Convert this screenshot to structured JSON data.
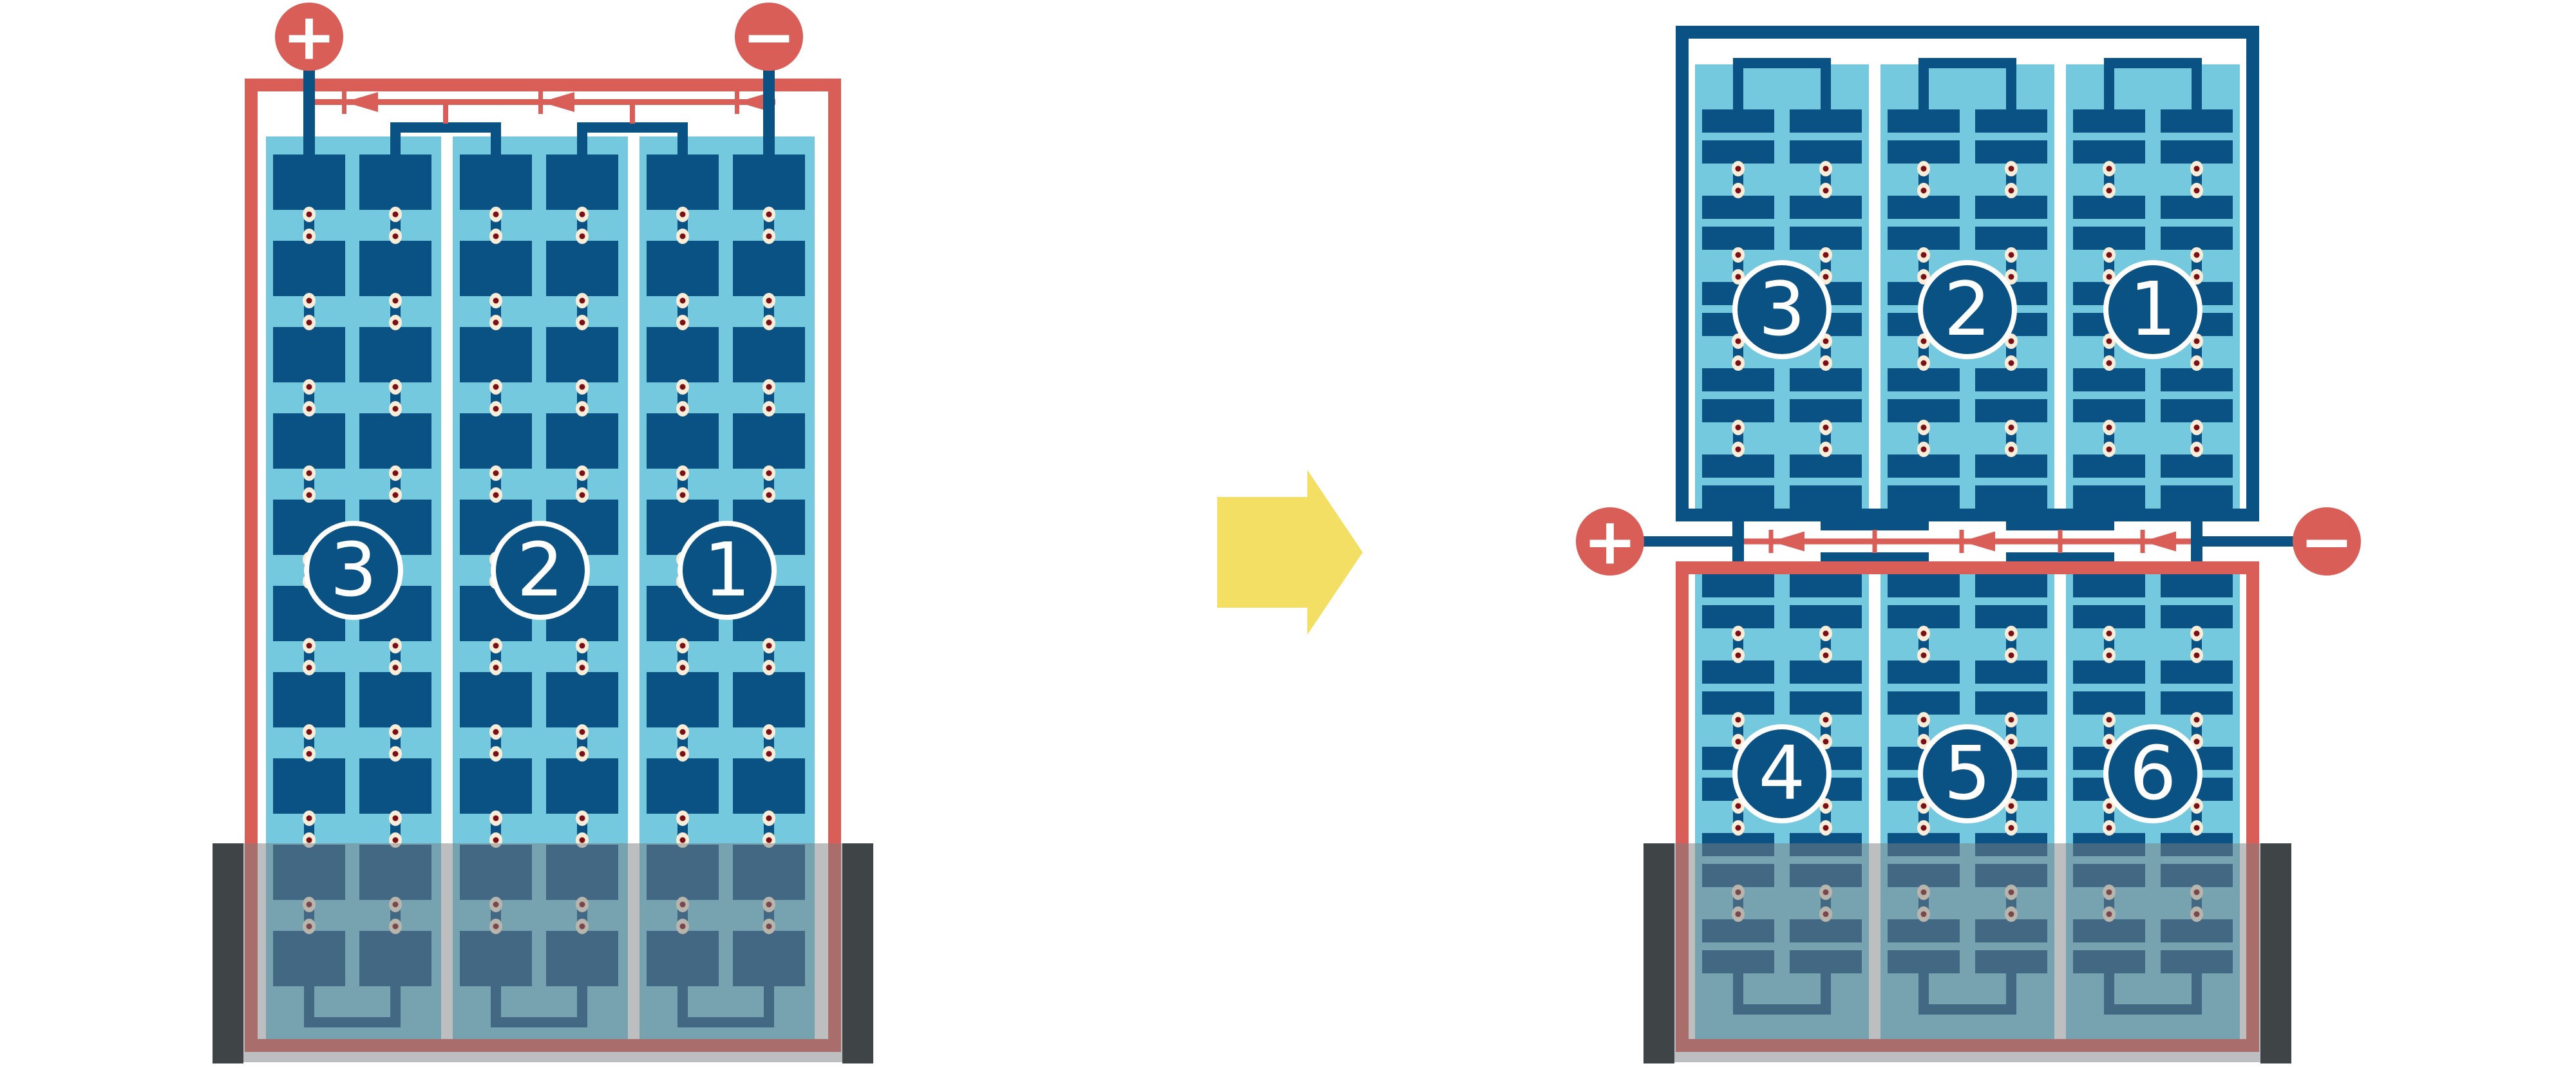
{
  "left_battery": {
    "cells": [
      {
        "label": "3"
      },
      {
        "label": "2"
      },
      {
        "label": "1"
      }
    ],
    "terminals": {
      "positive": {
        "label": "+"
      },
      "negative": {
        "label": "−"
      }
    }
  },
  "right_battery": {
    "top_row_cells": [
      {
        "label": "3"
      },
      {
        "label": "2"
      },
      {
        "label": "1"
      }
    ],
    "bottom_row_cells": [
      {
        "label": "4"
      },
      {
        "label": "5"
      },
      {
        "label": "6"
      }
    ],
    "terminals": {
      "positive": {
        "label": "+"
      },
      "negative": {
        "label": "−"
      }
    }
  },
  "icons": {
    "transform_arrow": "arrow-right-icon",
    "current_direction": "current-direction-arrow-icon",
    "positive": "plus-icon",
    "negative": "minus-icon"
  },
  "colors": {
    "case_and_terminal_red": "#D95E57",
    "plate_dark_blue": "#0B5284",
    "electrolyte_light_blue": "#74C9DE",
    "connector_rivet_cream": "#F7EDD8",
    "connector_rivet_dark_red": "#7A1016",
    "transform_arrow_yellow": "#F2DF63",
    "holder_bar_charcoal": "#3F4546",
    "holder_veil_gray": "#7A7E81",
    "background": "#FFFFFF"
  }
}
